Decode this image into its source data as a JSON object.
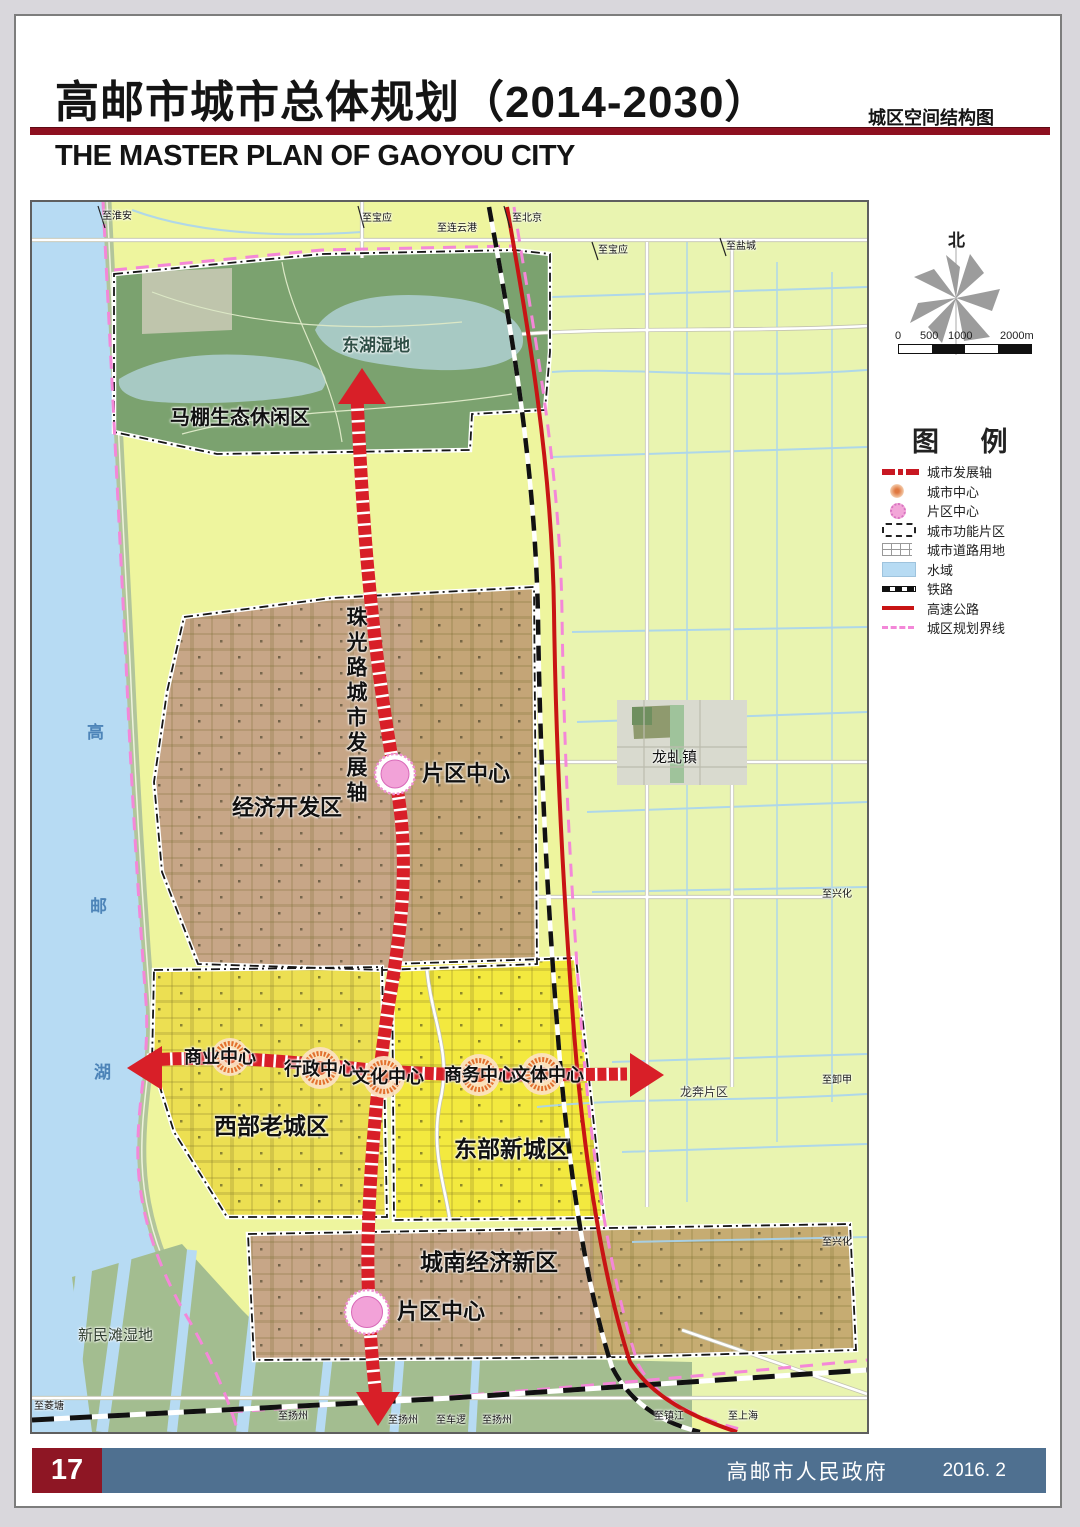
{
  "header": {
    "title": "高邮市城市总体规划（2014-2030）",
    "subtitle_right": "城区空间结构图",
    "title_en": "THE MASTER PLAN OF GAOYOU CITY"
  },
  "compass": {
    "north": "北"
  },
  "scalebar": {
    "ticks": [
      "0",
      "500",
      "1000",
      "2000m"
    ]
  },
  "legend": {
    "title": "图 例",
    "items": [
      {
        "label": "城市发展轴",
        "symbol": "development-axis"
      },
      {
        "label": "城市中心",
        "symbol": "city-center"
      },
      {
        "label": "片区中心",
        "symbol": "district-center"
      },
      {
        "label": "城市功能片区",
        "symbol": "functional-district"
      },
      {
        "label": "城市道路用地",
        "symbol": "urban-road-land"
      },
      {
        "label": "水域",
        "symbol": "water-area"
      },
      {
        "label": "铁路",
        "symbol": "railway"
      },
      {
        "label": "高速公路",
        "symbol": "expressway"
      },
      {
        "label": "城区规划界线",
        "symbol": "planning-boundary"
      }
    ]
  },
  "map": {
    "zones": {
      "eco_area": "马棚生态休闲区",
      "wetland": "东湖湿地",
      "econ_zone": "经济开发区",
      "west_zone": "西部老城区",
      "east_zone": "东部新城区",
      "south_zone": "城南经济新区",
      "longqiu_town": "龙虬镇",
      "longben_district": "龙奔片区",
      "xinmin_wetland": "新民滩湿地"
    },
    "axis_vertical": "珠光路城市发展轴",
    "district_center_1": "片区中心",
    "district_center_2": "片区中心",
    "centers": {
      "commercial": "商业中心",
      "admin": "行政中心",
      "culture": "文化中心",
      "business": "商务中心",
      "sports": "文体中心"
    },
    "lake_name": [
      "高",
      "邮",
      "湖"
    ],
    "edge": [
      {
        "text": "至淮安"
      },
      {
        "text": "至宝应"
      },
      {
        "text": "至连云港"
      },
      {
        "text": "至北京"
      },
      {
        "text": "至宝应"
      },
      {
        "text": "至盐城"
      },
      {
        "text": "至兴化"
      },
      {
        "text": "至卸甲"
      },
      {
        "text": "至兴化"
      },
      {
        "text": "至菱塘"
      },
      {
        "text": "至扬州"
      },
      {
        "text": "至扬州"
      },
      {
        "text": "至车逻"
      },
      {
        "text": "至扬州"
      },
      {
        "text": "至镇江"
      },
      {
        "text": "至上海"
      }
    ]
  },
  "footer": {
    "page_number": "17",
    "publisher": "高邮市人民政府",
    "date": "2016. 2"
  }
}
